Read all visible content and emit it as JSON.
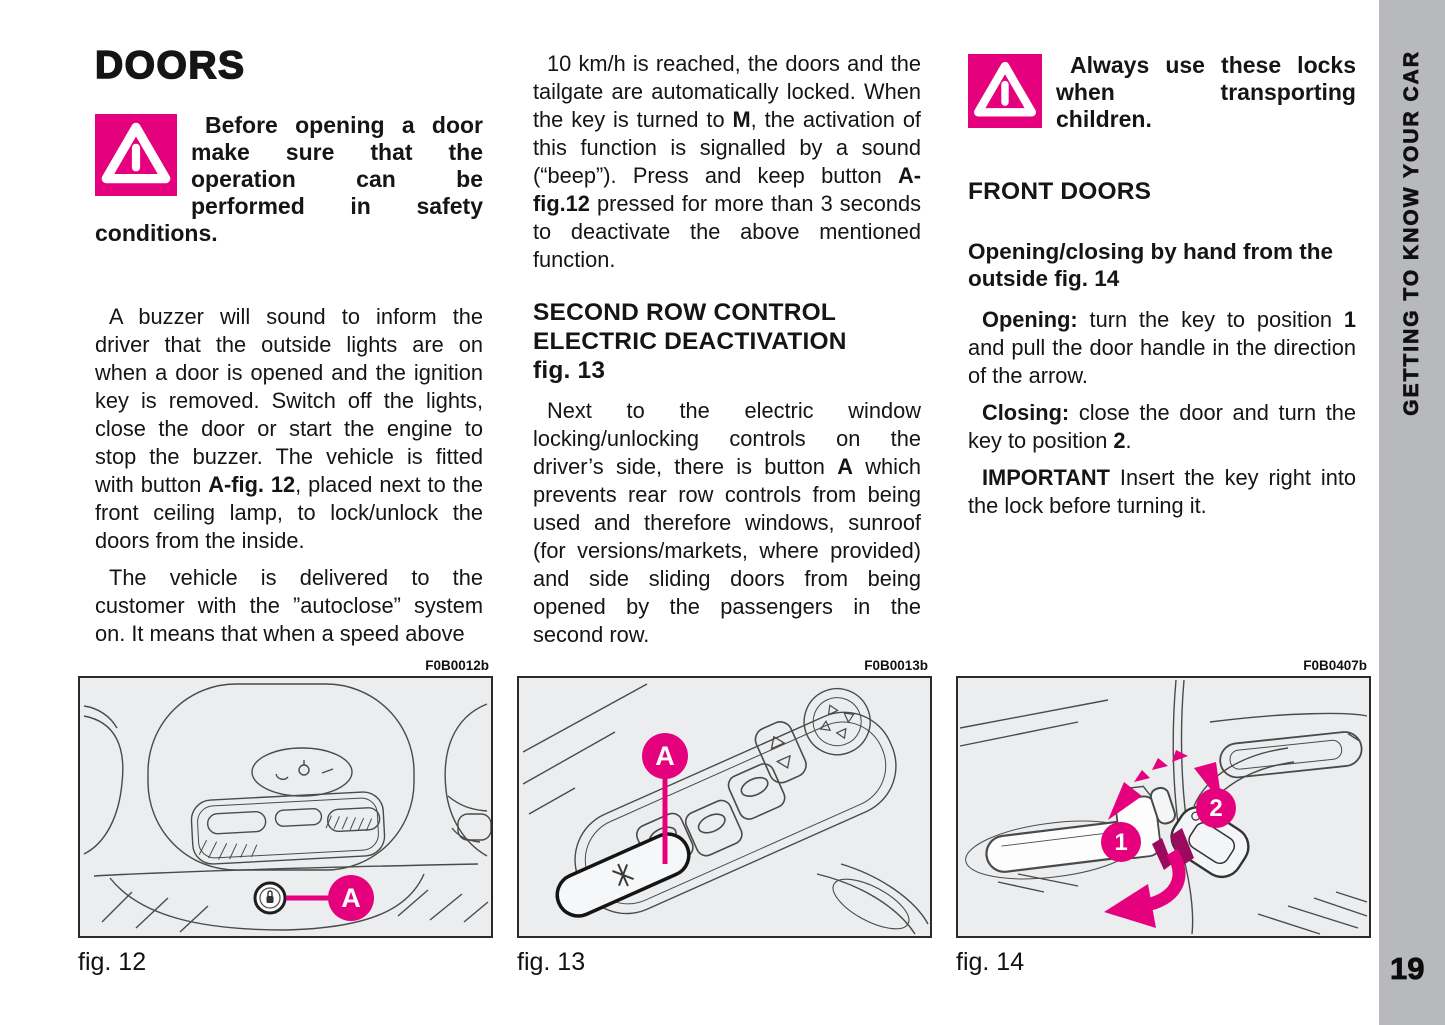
{
  "title": "DOORS",
  "sidebar": {
    "label": "GETTING TO KNOW YOUR CAR",
    "page_number": "19"
  },
  "colors": {
    "accent": "#e5017d",
    "accent_dark": "#9b0a5e",
    "sidebar_gray": "#b8b9bd",
    "figure_bg": "#ebedef"
  },
  "col1": {
    "warning": [
      {
        "t": "Before opening a door make sure that the operation can be performed in safety conditions.",
        "b": true
      }
    ],
    "p1": [
      {
        "t": "A buzzer will sound to inform the driver that the outside lights are on when a door is opened and the ignition key is removed. Switch off the lights, close the door or start the engine to stop the buzzer. The vehicle is fitted with button ",
        "b": false
      },
      {
        "t": "A-fig. 12",
        "b": true
      },
      {
        "t": ", placed next to the front ceiling lamp, to lock/unlock the doors from the inside.",
        "b": false
      }
    ],
    "p2": [
      {
        "t": "The vehicle is delivered to the customer with the ”autoclose” system on. It means that when a speed above",
        "b": false
      }
    ]
  },
  "col2": {
    "p1": [
      {
        "t": "10 km/h is reached, the doors and the tailgate are automatically locked. When the key is turned to ",
        "b": false
      },
      {
        "t": "M",
        "b": true
      },
      {
        "t": ", the activation of this function is signalled by a sound (“beep”). Press and keep button ",
        "b": false
      },
      {
        "t": "A-fig.12",
        "b": true
      },
      {
        "t": " pressed for more than 3 seconds to deactivate the above mentioned function.",
        "b": false
      }
    ],
    "heading": "SECOND ROW CONTROL\nELECTRIC DEACTIVATION\nfig. 13",
    "p2": [
      {
        "t": "Next to the electric window locking/unlocking controls on the driver’s side, there is button ",
        "b": false
      },
      {
        "t": "A",
        "b": true
      },
      {
        "t": " which prevents rear row controls from being used and therefore windows, sunroof (for versions/markets, where provided) and side sliding doors from being opened by the passengers in the second row.",
        "b": false
      }
    ]
  },
  "col3": {
    "warning": [
      {
        "t": "Always use these locks when transporting children.",
        "b": true
      }
    ],
    "heading": "FRONT DOORS",
    "subheading": "Opening/closing by hand from the outside fig. 14",
    "p1": [
      {
        "t": "Opening:",
        "b": true
      },
      {
        "t": " turn the key to position ",
        "b": false
      },
      {
        "t": "1",
        "b": true
      },
      {
        "t": " and pull the door handle in the direction of the arrow.",
        "b": false
      }
    ],
    "p2": [
      {
        "t": "Closing:",
        "b": true
      },
      {
        "t": " close the door and turn the key to position ",
        "b": false
      },
      {
        "t": "2",
        "b": true
      },
      {
        "t": ".",
        "b": false
      }
    ],
    "p3": [
      {
        "t": "IMPORTANT",
        "b": true
      },
      {
        "t": " Insert the key right into the lock before turning it.",
        "b": false
      }
    ]
  },
  "figures": [
    {
      "code": "F0B0012b",
      "caption": "fig. 12",
      "callout": "A"
    },
    {
      "code": "F0B0013b",
      "caption": "fig. 13",
      "callout": "A"
    },
    {
      "code": "F0B0407b",
      "caption": "fig. 14",
      "callout1": "1",
      "callout2": "2"
    }
  ]
}
